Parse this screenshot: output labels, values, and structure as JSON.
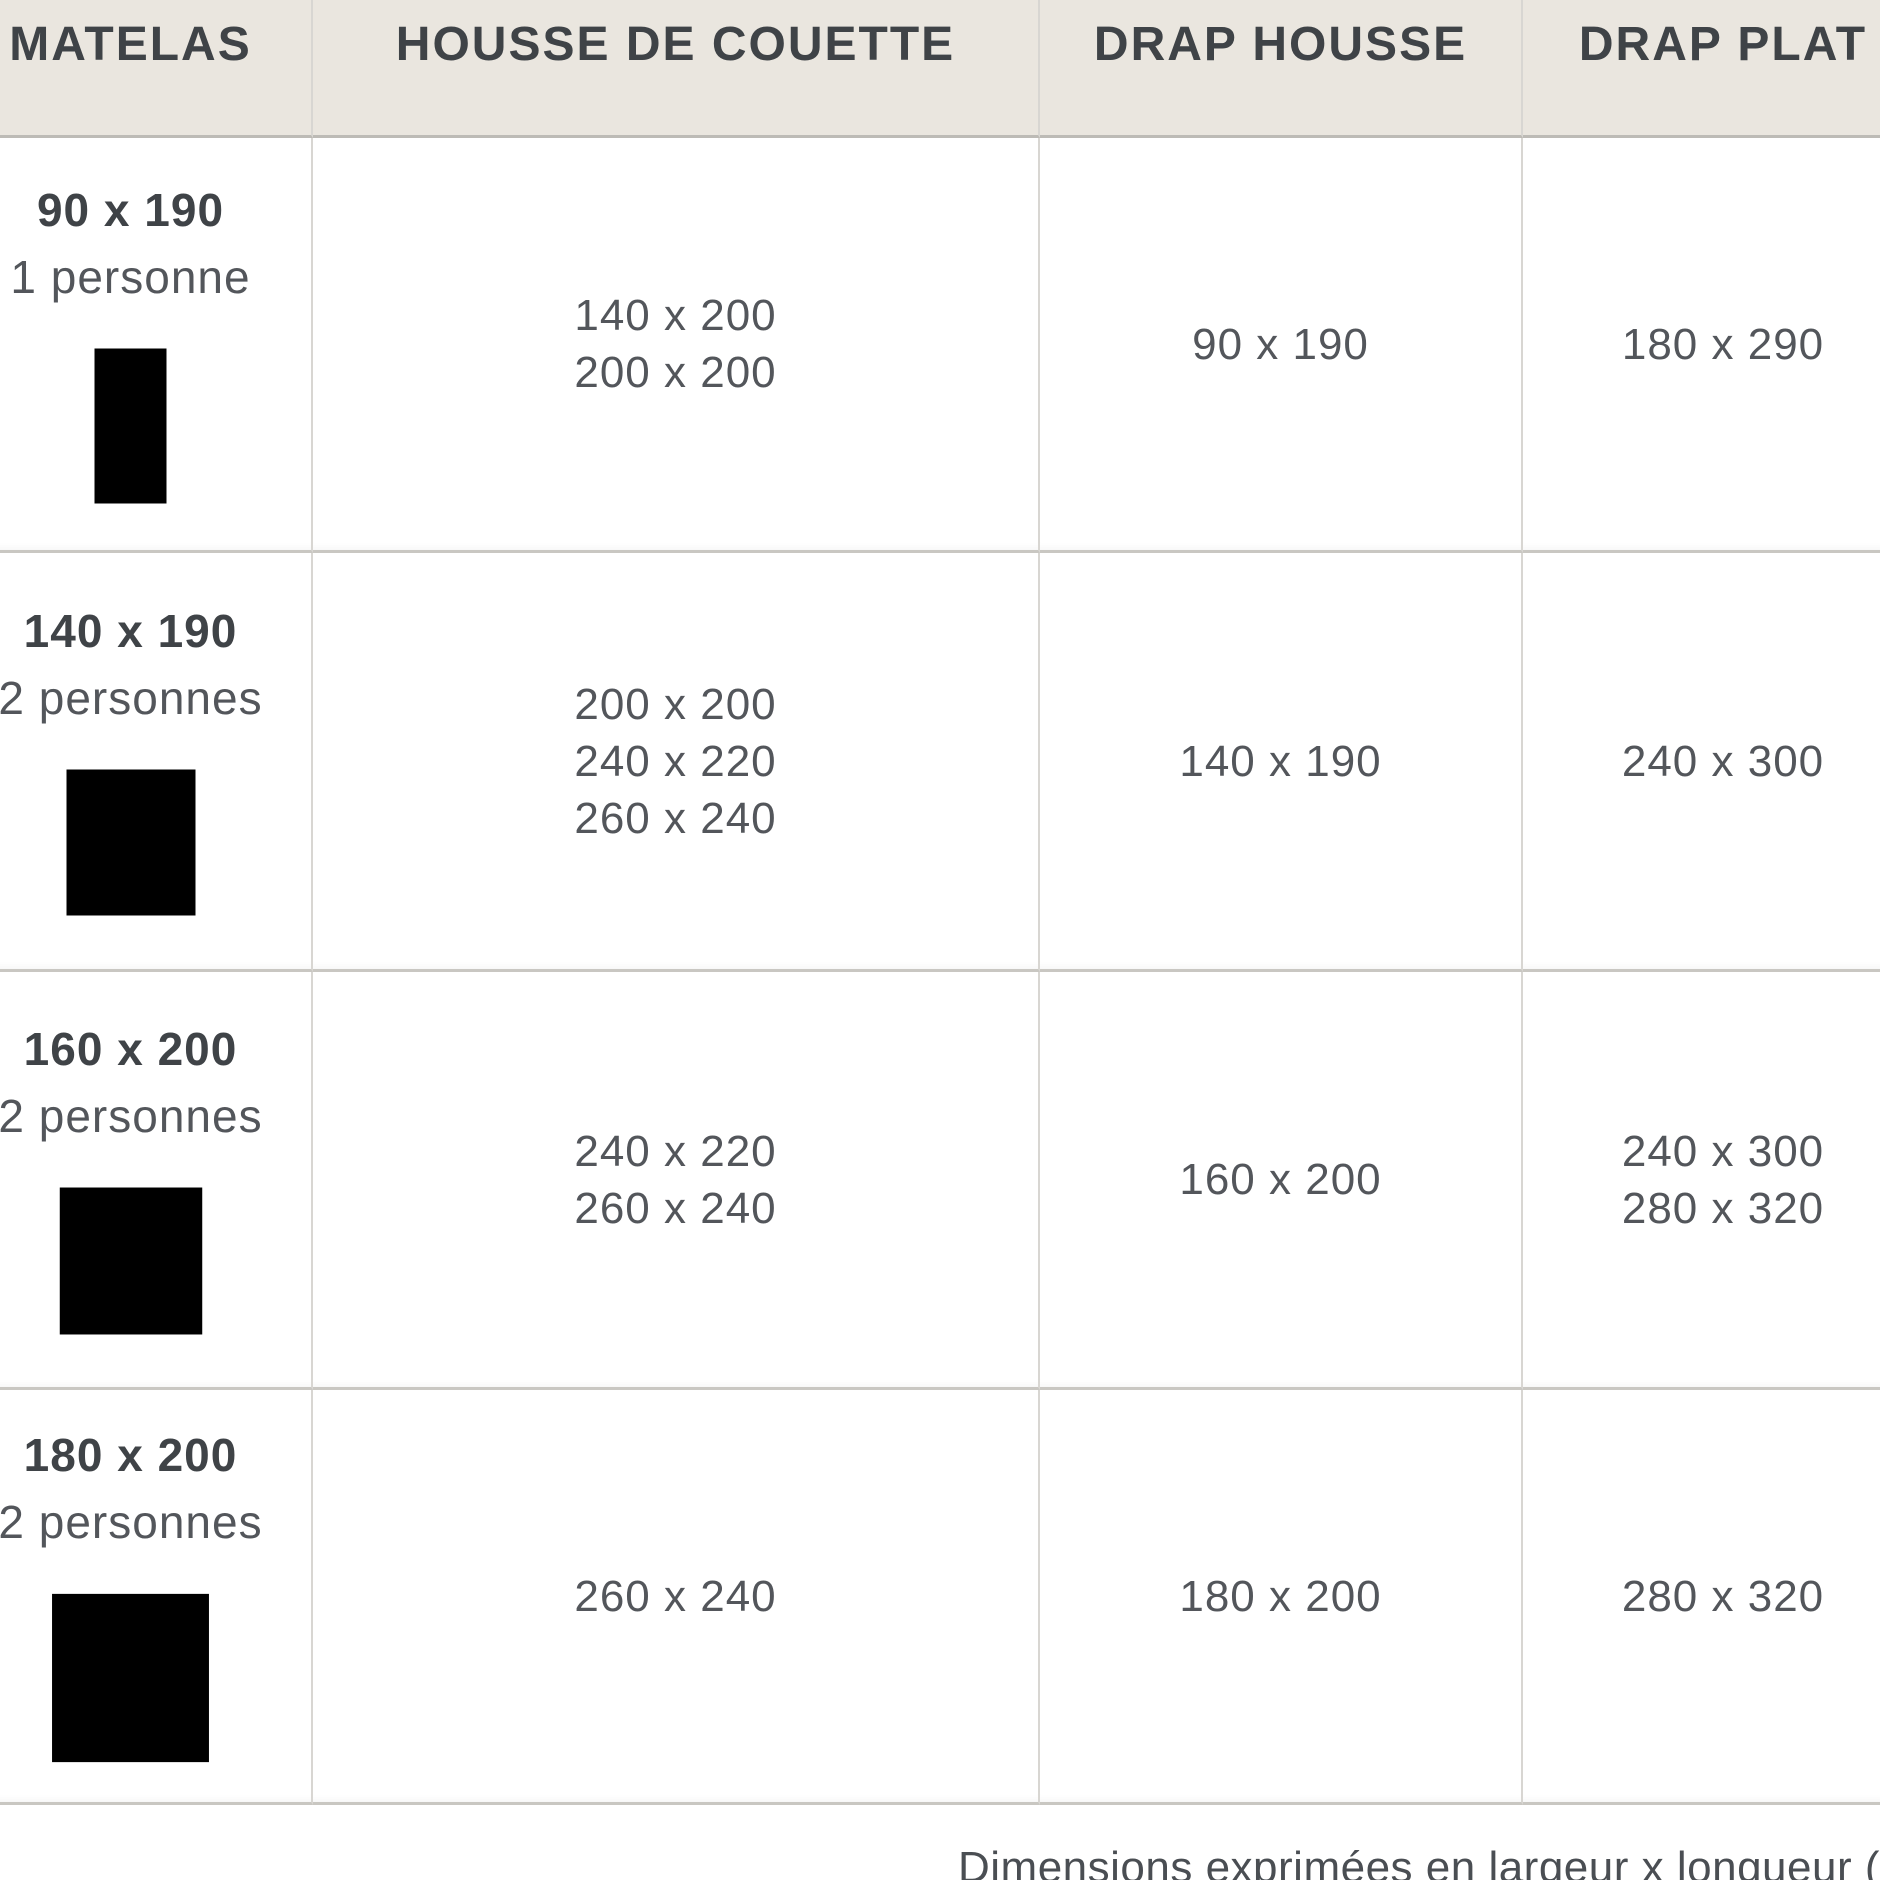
{
  "table": {
    "columns": [
      {
        "label": "MATELAS"
      },
      {
        "label": "HOUSSE DE COUETTE"
      },
      {
        "label": "DRAP HOUSSE"
      },
      {
        "label": "DRAP PLAT"
      }
    ],
    "rows": [
      {
        "mattress_size": "90 x 190",
        "capacity": "1 personne",
        "icon": "single-bed-icon",
        "duvet_cover": [
          "140 x 200",
          "200 x 200"
        ],
        "fitted_sheet": [
          "90 x 190"
        ],
        "flat_sheet": [
          "180 x 290"
        ]
      },
      {
        "mattress_size": "140 x 190",
        "capacity": "2 personnes",
        "icon": "double-bed-icon",
        "duvet_cover": [
          "200 x 200",
          "240 x 220",
          "260 x 240"
        ],
        "fitted_sheet": [
          "140 x 190"
        ],
        "flat_sheet": [
          "240 x 300"
        ]
      },
      {
        "mattress_size": "160 x 200",
        "capacity": "2 personnes",
        "icon": "double-bed-icon",
        "duvet_cover": [
          "240 x 220",
          "260 x 240"
        ],
        "fitted_sheet": [
          "160 x 200"
        ],
        "flat_sheet": [
          "240 x 300",
          "280 x 320"
        ]
      },
      {
        "mattress_size": "180 x 200",
        "capacity": "2 personnes",
        "icon": "double-bed-icon",
        "duvet_cover": [
          "260 x 240"
        ],
        "fitted_sheet": [
          "180 x 200"
        ],
        "flat_sheet": [
          "280 x 320"
        ]
      }
    ]
  },
  "footer": {
    "note": "Dimensions exprimées en largeur x longueur (cm"
  },
  "colors": {
    "header_bg": "#EAE6DF",
    "horizontal_divider": "#C9C7C2",
    "vertical_divider": "#D8D6D2",
    "heading_text": "#3F4347",
    "body_text": "#53565B",
    "icon_stroke": "#45484C"
  }
}
